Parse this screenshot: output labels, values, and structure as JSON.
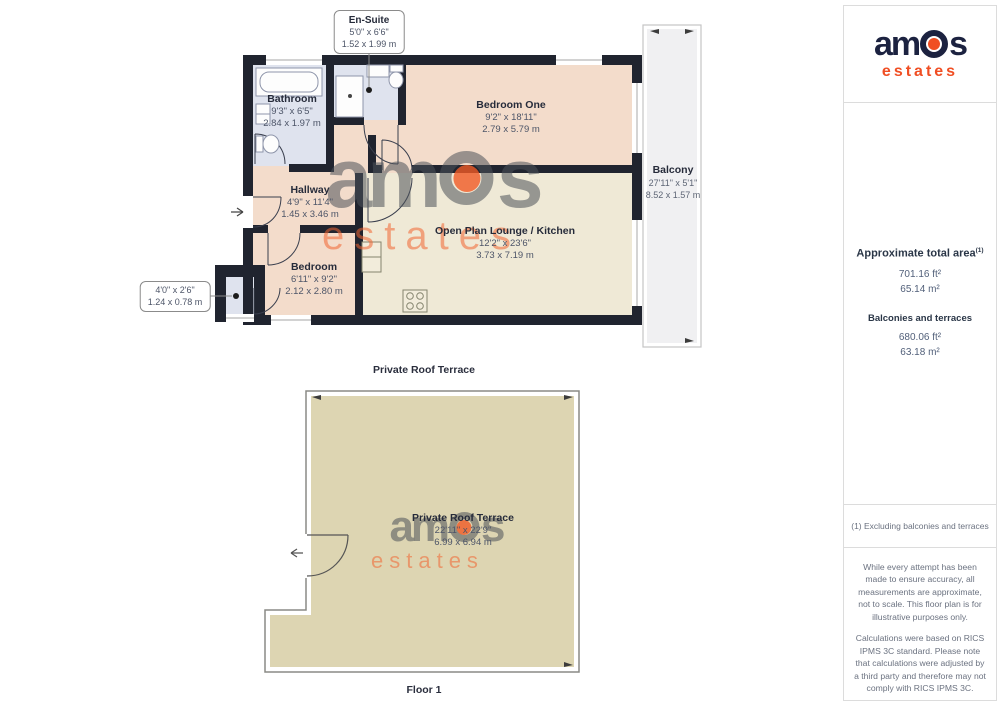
{
  "logo": {
    "part1": "am",
    "part2": "s",
    "sub": "estates",
    "navy": "#1c2240",
    "orange": "#f04e23"
  },
  "watermark": {
    "part1": "am",
    "part2": "s",
    "sub": "estates"
  },
  "floorplan": {
    "captions": {
      "terrace": "Private Roof Terrace",
      "floor": "Floor 1"
    },
    "callouts": {
      "ensuite": {
        "title": "En-Suite",
        "imperial": "5'0\" x 6'6\"",
        "metric": "1.52 x 1.99 m"
      },
      "store": {
        "imperial": "4'0\" x 2'6\"",
        "metric": "1.24 x 0.78 m"
      }
    },
    "rooms": {
      "bathroom": {
        "name": "Bathroom",
        "imperial": "9'3\" x 6'5\"",
        "metric": "2.84 x 1.97 m"
      },
      "bedroom_one": {
        "name": "Bedroom One",
        "imperial": "9'2\" x 18'11\"",
        "metric": "2.79 x 5.79 m"
      },
      "hallway": {
        "name": "Hallway",
        "imperial": "4'9\" x 11'4\"",
        "metric": "1.45 x 3.46 m"
      },
      "bedroom": {
        "name": "Bedroom",
        "imperial": "6'11\" x 9'2\"",
        "metric": "2.12 x 2.80 m"
      },
      "lounge": {
        "name": "Open Plan Lounge / Kitchen",
        "imperial": "12'2\" x 23'6\"",
        "metric": "3.73 x 7.19 m"
      },
      "balcony": {
        "name": "Balcony",
        "imperial": "27'11\" x 5'1\"",
        "metric": "8.52 x 1.57 m"
      },
      "terrace": {
        "name": "Private Roof Terrace",
        "imperial": "22'11\" x 22'9\"",
        "metric": "6.99 x 6.94 m"
      }
    },
    "colors": {
      "walls": "#20242f",
      "room_pink": "#f3dccb",
      "room_cream": "#efe9d6",
      "room_blue": "#dfe3ee",
      "terrace_tan": "#ddd5b2",
      "balcony_gray": "#f0f0f2"
    }
  },
  "sidebar": {
    "areas": {
      "title": "Approximate total area",
      "title_sup": "(1)",
      "total_ft": "701.16 ft²",
      "total_m": "65.14 m²",
      "subtitle": "Balconies and terraces",
      "balconies_ft": "680.06 ft²",
      "balconies_m": "63.18 m²"
    },
    "footnote": "(1) Excluding balconies and terraces",
    "disclaimer": {
      "p1": "While every attempt has been made to ensure accuracy, all measurements are approximate, not to scale. This floor plan is for illustrative purposes only.",
      "p2": "Calculations were based on RICS IPMS 3C standard. Please note that calculations were adjusted by a third party and therefore may not comply with RICS IPMS 3C.",
      "credit_prefix": "GIRAFFE",
      "credit_suffix": "360"
    }
  }
}
